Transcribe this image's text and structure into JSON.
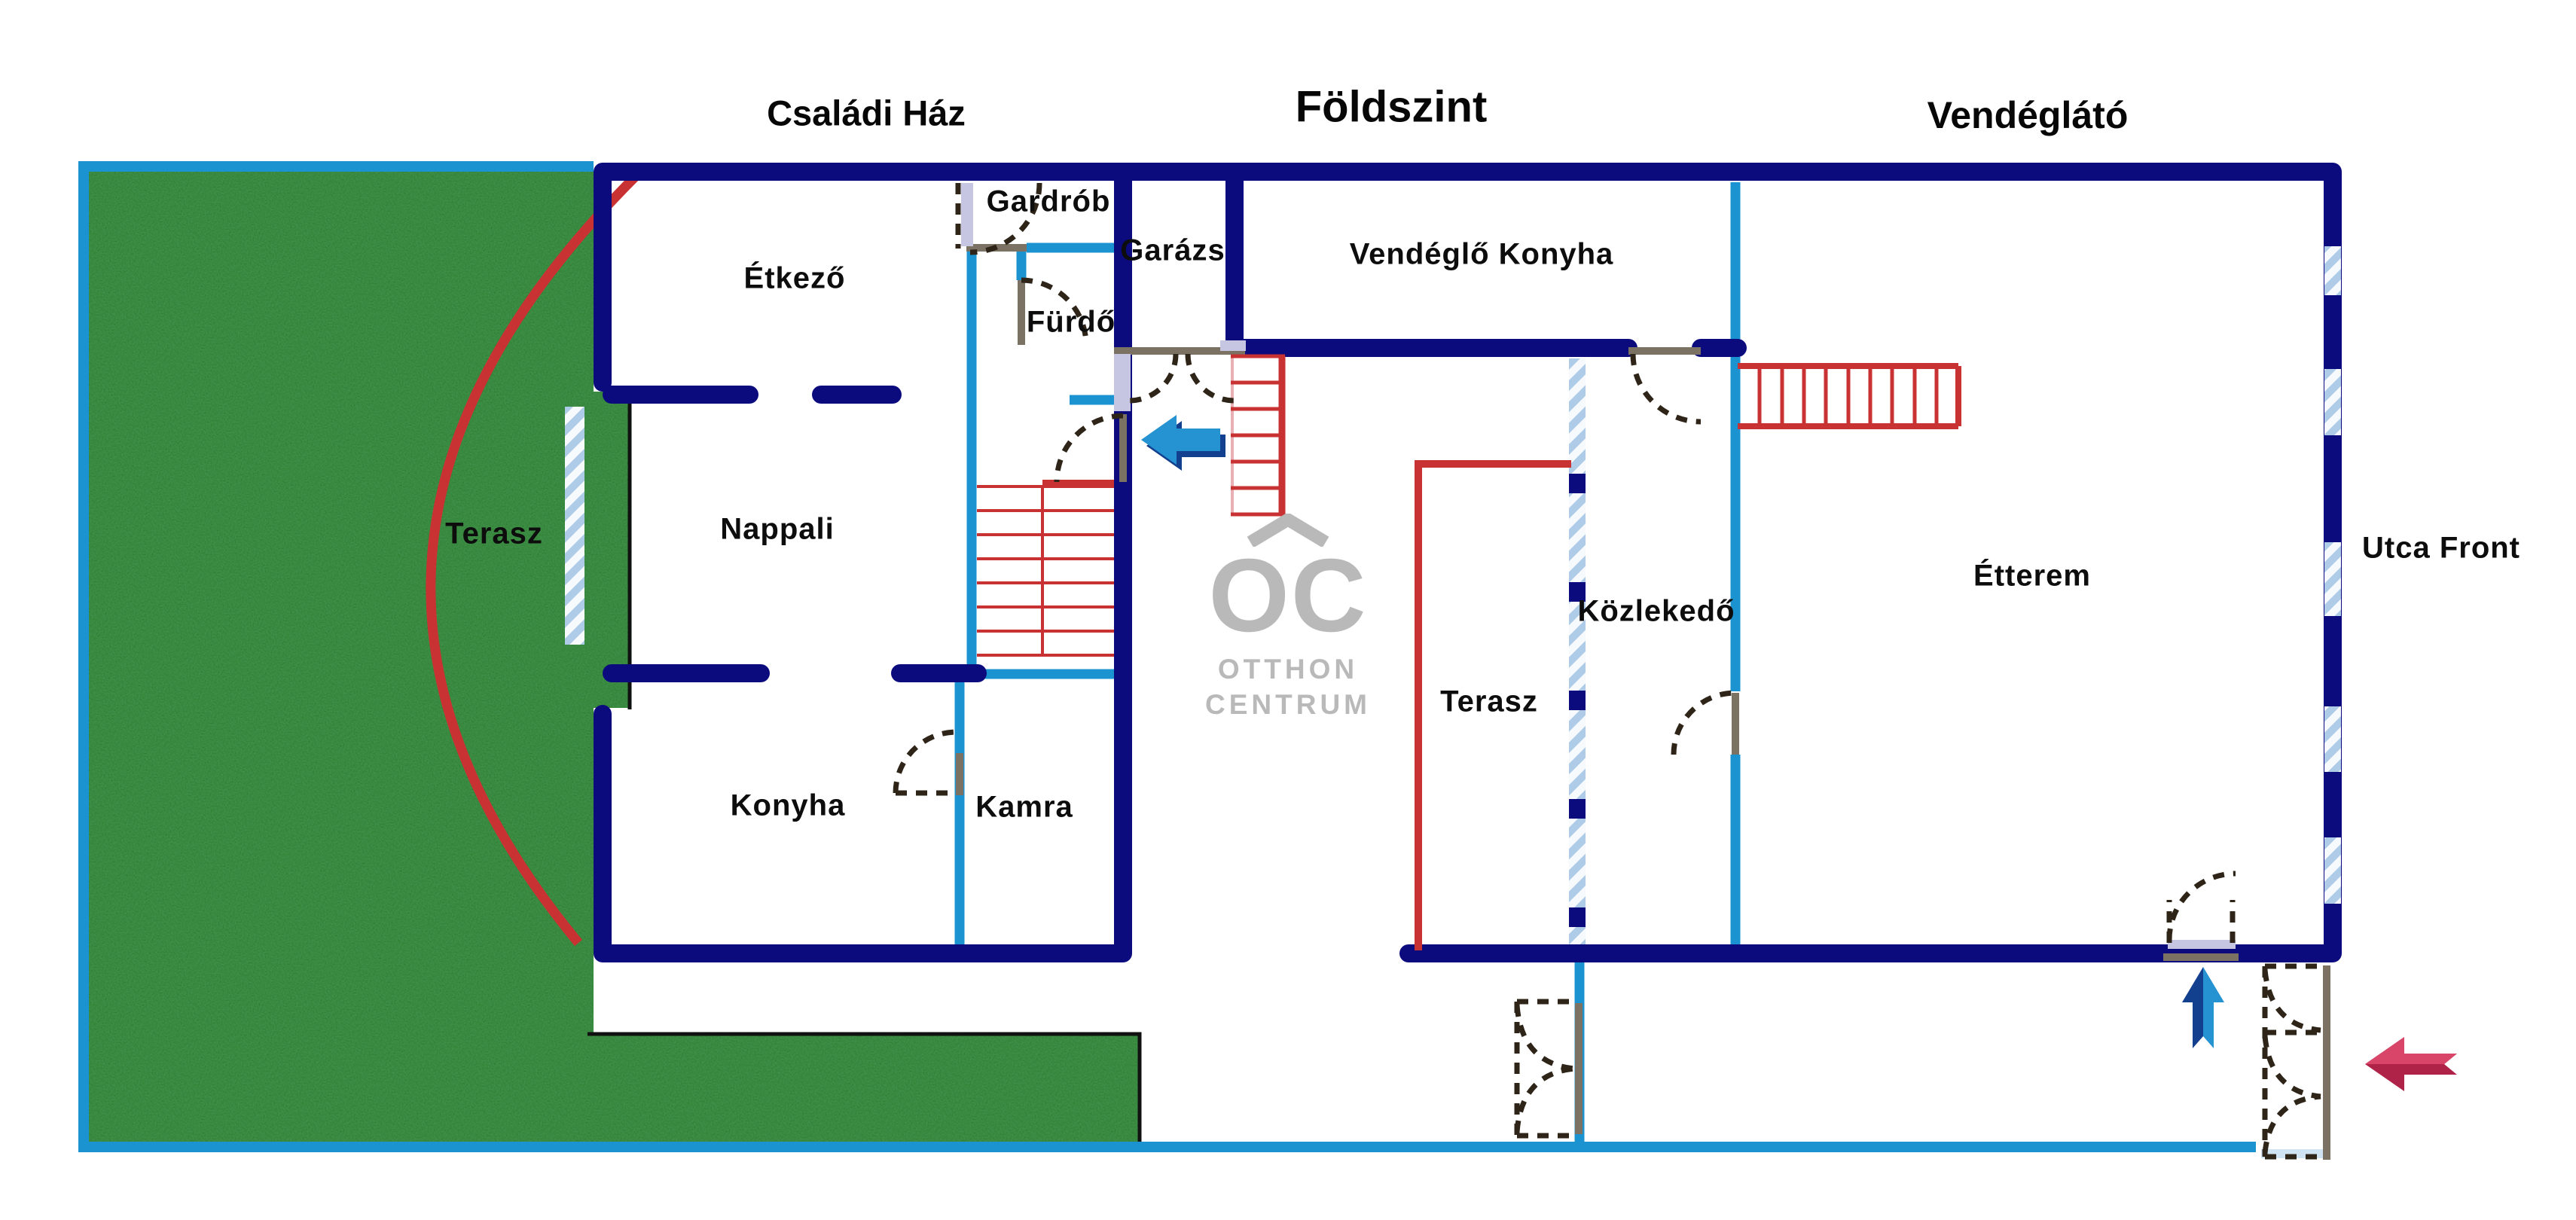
{
  "titles": {
    "left": "Családi Ház",
    "center": "Földszint",
    "right": "Vendéglátó"
  },
  "rooms": {
    "gardrob": "Gardrób",
    "etkezo": "Étkező",
    "garazs": "Garázs",
    "vendeglo_konyha": "Vendéglő Konyha",
    "furdo": "Fürdő",
    "terasz_garden": "Terasz",
    "nappali": "Nappali",
    "kozlekedo": "Közlekedő",
    "etterem": "Étterem",
    "utca_front": "Utca Front",
    "terasz_middle": "Terasz",
    "konyha": "Konyha",
    "kamra": "Kamra"
  },
  "logo": {
    "monogram": "OC",
    "word1": "OTTHON",
    "word2": "CENTRUM"
  },
  "arrows": [
    {
      "id": "entry-arrow",
      "direction": "left",
      "color": "#2592d2"
    },
    {
      "id": "courtyard-arrow",
      "direction": "up",
      "color": "#2592d2"
    },
    {
      "id": "street-entrance-arrow",
      "direction": "left",
      "color": "#d84568"
    }
  ],
  "colors": {
    "wall_navy": "#0b0b7e",
    "wall_cyan": "#1b93d0",
    "stair_red": "#c83232",
    "stair_pink": "#e8b0b4",
    "terrace_red": "#c83232",
    "grass_green": "#2e7d2e",
    "window_blue": "#aecbe8",
    "threshold_gray": "#7b7264",
    "door_leaf_lavender": "#c6c6e2",
    "door_dash": "#2e2418",
    "arrow_blue": "#2592d2",
    "arrow_blue_dark": "#123f8e",
    "arrow_crimson": "#d84568",
    "arrow_crimson_dark": "#b02348",
    "logo_gray": "#b9b9b9",
    "line_black": "#111111",
    "sill_pale": "#cfe3f2"
  }
}
